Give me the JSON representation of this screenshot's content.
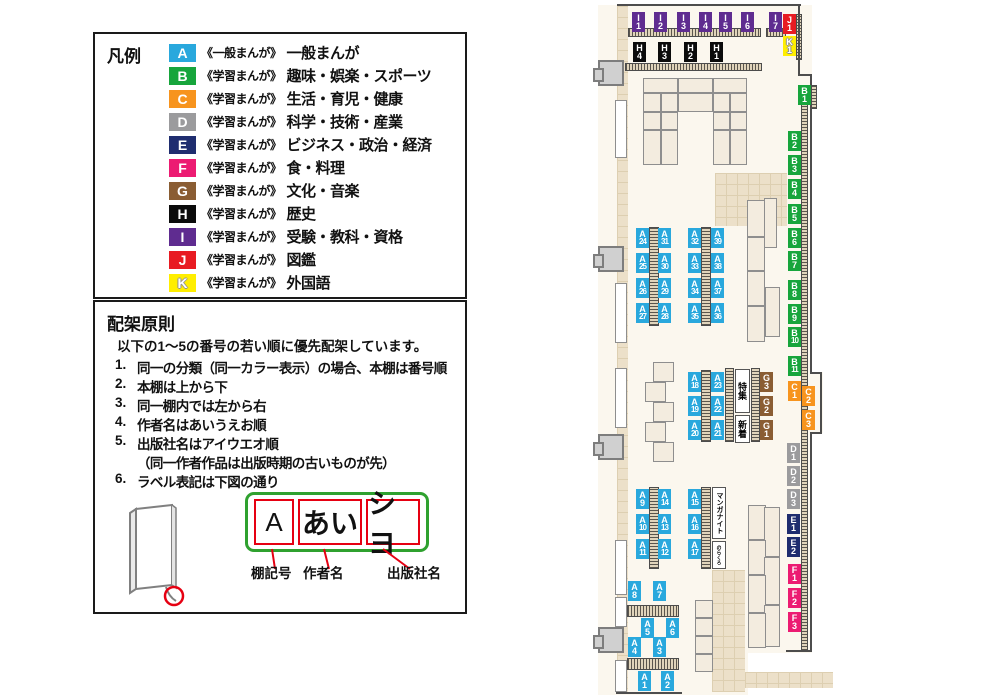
{
  "legend": {
    "title": "凡例",
    "items": [
      {
        "code": "A",
        "color": "#29a8dd",
        "scope": "《一般まんが》",
        "label": "一般まんが"
      },
      {
        "code": "B",
        "color": "#17a53c",
        "scope": "《学習まんが》",
        "label": "趣味・娯楽・スポーツ"
      },
      {
        "code": "C",
        "color": "#f7941e",
        "scope": "《学習まんが》",
        "label": "生活・育児・健康"
      },
      {
        "code": "D",
        "color": "#9b9b9d",
        "scope": "《学習まんが》",
        "label": "科学・技術・産業"
      },
      {
        "code": "E",
        "color": "#1f2d6f",
        "scope": "《学習まんが》",
        "label": "ビジネス・政治・経済"
      },
      {
        "code": "F",
        "color": "#ec1b72",
        "scope": "《学習まんが》",
        "label": "食・料理"
      },
      {
        "code": "G",
        "color": "#8a5d33",
        "scope": "《学習まんが》",
        "label": "文化・音楽"
      },
      {
        "code": "H",
        "color": "#0b0b0b",
        "scope": "《学習まんが》",
        "label": "歴史"
      },
      {
        "code": "I",
        "color": "#5f2c90",
        "scope": "《学習まんが》",
        "label": "受験・教科・資格"
      },
      {
        "code": "J",
        "color": "#e81b22",
        "scope": "《学習まんが》",
        "label": "図鑑"
      },
      {
        "code": "K",
        "color": "#ffee00",
        "scope": "《学習まんが》",
        "label": "外国語"
      }
    ]
  },
  "principles": {
    "title": "配架原則",
    "intro": "以下の1～5の番号の若い順に優先配架しています。",
    "items": [
      {
        "num": "1.",
        "text": "同一の分類（同一カラー表示）の場合、本棚は番号順"
      },
      {
        "num": "2.",
        "text": "本棚は上から下"
      },
      {
        "num": "3.",
        "text": "同一棚内では左から右"
      },
      {
        "num": "4.",
        "text": "作者名はあいうえお順"
      },
      {
        "num": "5.",
        "text": "出版社名はアイウエオ順",
        "note": "（同一作者作品は出版時期の古いものが先）"
      },
      {
        "num": "6.",
        "text": "ラベル表記は下図の通り"
      }
    ]
  },
  "label_diagram": {
    "boxes": [
      {
        "value": "A",
        "caption": "棚記号"
      },
      {
        "value": "あい",
        "caption": "作者名"
      },
      {
        "value": "シヨ",
        "caption": "出版社名"
      }
    ]
  },
  "map": {
    "colors": {
      "A": "#29a8dd",
      "B": "#17a53c",
      "C": "#f7941e",
      "D": "#9b9b9d",
      "E": "#1f2d6f",
      "F": "#ec1b72",
      "G": "#8a5d33",
      "H": "#0b0b0b",
      "I": "#5f2c90",
      "J": "#e81b22",
      "K": "#ffee00"
    },
    "labels": [
      {
        "id": "I1",
        "x": 632,
        "y": 12
      },
      {
        "id": "I2",
        "x": 654,
        "y": 12
      },
      {
        "id": "I3",
        "x": 677,
        "y": 12
      },
      {
        "id": "I4",
        "x": 699,
        "y": 12
      },
      {
        "id": "I5",
        "x": 719,
        "y": 12
      },
      {
        "id": "I6",
        "x": 741,
        "y": 12
      },
      {
        "id": "I7",
        "x": 769,
        "y": 12
      },
      {
        "id": "J1",
        "x": 783,
        "y": 14
      },
      {
        "id": "K1",
        "x": 783,
        "y": 36
      },
      {
        "id": "H4",
        "x": 633,
        "y": 42
      },
      {
        "id": "H3",
        "x": 658,
        "y": 42
      },
      {
        "id": "H2",
        "x": 684,
        "y": 42
      },
      {
        "id": "H1",
        "x": 710,
        "y": 42
      },
      {
        "id": "B1",
        "x": 798,
        "y": 85
      },
      {
        "id": "B2",
        "x": 788,
        "y": 131
      },
      {
        "id": "B3",
        "x": 788,
        "y": 155
      },
      {
        "id": "B4",
        "x": 788,
        "y": 179
      },
      {
        "id": "B5",
        "x": 788,
        "y": 204
      },
      {
        "id": "B6",
        "x": 788,
        "y": 228
      },
      {
        "id": "B7",
        "x": 788,
        "y": 251
      },
      {
        "id": "B8",
        "x": 788,
        "y": 280
      },
      {
        "id": "B9",
        "x": 788,
        "y": 304
      },
      {
        "id": "B10",
        "x": 788,
        "y": 327
      },
      {
        "id": "B11",
        "x": 788,
        "y": 356
      },
      {
        "id": "C1",
        "x": 788,
        "y": 381
      },
      {
        "id": "C2",
        "x": 802,
        "y": 386
      },
      {
        "id": "C3",
        "x": 802,
        "y": 410
      },
      {
        "id": "D1",
        "x": 787,
        "y": 443
      },
      {
        "id": "D2",
        "x": 787,
        "y": 466
      },
      {
        "id": "D3",
        "x": 787,
        "y": 489
      },
      {
        "id": "E1",
        "x": 787,
        "y": 514
      },
      {
        "id": "E2",
        "x": 787,
        "y": 537
      },
      {
        "id": "F1",
        "x": 788,
        "y": 564
      },
      {
        "id": "F2",
        "x": 788,
        "y": 588
      },
      {
        "id": "F3",
        "x": 788,
        "y": 612
      },
      {
        "id": "G3",
        "x": 760,
        "y": 372
      },
      {
        "id": "G2",
        "x": 760,
        "y": 396
      },
      {
        "id": "G1",
        "x": 760,
        "y": 420
      },
      {
        "id": "A24",
        "x": 636,
        "y": 228
      },
      {
        "id": "A25",
        "x": 636,
        "y": 253
      },
      {
        "id": "A26",
        "x": 636,
        "y": 278
      },
      {
        "id": "A27",
        "x": 636,
        "y": 303
      },
      {
        "id": "A31",
        "x": 658,
        "y": 228
      },
      {
        "id": "A30",
        "x": 658,
        "y": 253
      },
      {
        "id": "A29",
        "x": 658,
        "y": 278
      },
      {
        "id": "A28",
        "x": 658,
        "y": 303
      },
      {
        "id": "A32",
        "x": 688,
        "y": 228
      },
      {
        "id": "A33",
        "x": 688,
        "y": 253
      },
      {
        "id": "A34",
        "x": 688,
        "y": 278
      },
      {
        "id": "A35",
        "x": 688,
        "y": 303
      },
      {
        "id": "A39",
        "x": 711,
        "y": 228
      },
      {
        "id": "A38",
        "x": 711,
        "y": 253
      },
      {
        "id": "A37",
        "x": 711,
        "y": 278
      },
      {
        "id": "A36",
        "x": 711,
        "y": 303
      },
      {
        "id": "A18",
        "x": 688,
        "y": 372
      },
      {
        "id": "A19",
        "x": 688,
        "y": 396
      },
      {
        "id": "A20",
        "x": 688,
        "y": 420
      },
      {
        "id": "A23",
        "x": 711,
        "y": 372
      },
      {
        "id": "A22",
        "x": 711,
        "y": 396
      },
      {
        "id": "A21",
        "x": 711,
        "y": 420
      },
      {
        "id": "A9",
        "x": 636,
        "y": 489
      },
      {
        "id": "A10",
        "x": 636,
        "y": 514
      },
      {
        "id": "A11",
        "x": 636,
        "y": 539
      },
      {
        "id": "A14",
        "x": 658,
        "y": 489
      },
      {
        "id": "A13",
        "x": 658,
        "y": 514
      },
      {
        "id": "A12",
        "x": 658,
        "y": 539
      },
      {
        "id": "A15",
        "x": 688,
        "y": 489
      },
      {
        "id": "A16",
        "x": 688,
        "y": 514
      },
      {
        "id": "A17",
        "x": 688,
        "y": 539
      },
      {
        "id": "A8",
        "x": 628,
        "y": 581
      },
      {
        "id": "A7",
        "x": 653,
        "y": 581
      },
      {
        "id": "A5",
        "x": 641,
        "y": 618
      },
      {
        "id": "A6",
        "x": 666,
        "y": 618
      },
      {
        "id": "A4",
        "x": 628,
        "y": 637
      },
      {
        "id": "A3",
        "x": 653,
        "y": 637
      },
      {
        "id": "A1",
        "x": 638,
        "y": 671
      },
      {
        "id": "A2",
        "x": 661,
        "y": 671
      }
    ],
    "text_boxes": [
      {
        "text": "特集",
        "x": 735,
        "y": 369,
        "w": 15,
        "h": 44
      },
      {
        "text": "新着",
        "x": 735,
        "y": 415,
        "w": 15,
        "h": 28
      },
      {
        "text": "マンガナイト",
        "x": 712,
        "y": 487,
        "w": 14,
        "h": 52
      },
      {
        "text": "のらくろ",
        "x": 712,
        "y": 541,
        "w": 14,
        "h": 28
      }
    ]
  }
}
